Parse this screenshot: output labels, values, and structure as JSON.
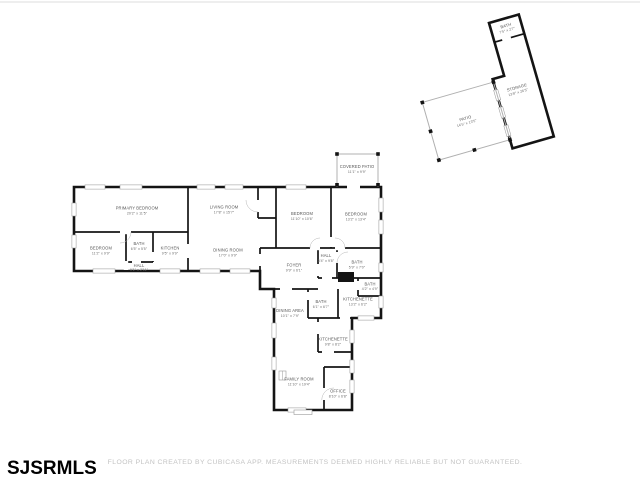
{
  "branding": {
    "logo": "SJSRMLS"
  },
  "footer": {
    "disclaimer": "FLOOR PLAN CREATED BY CUBICASA APP. MEASUREMENTS DEEMED HIGHLY RELIABLE BUT NOT GUARANTEED."
  },
  "colors": {
    "wall": "#141414",
    "label": "#555555",
    "window": "#9a9a9a",
    "patio_wall": "#b0b0b0",
    "disclaimer": "#c3c3c3",
    "background": "#ffffff"
  },
  "rooms": [
    {
      "name": "PRIMARY BEDROOM",
      "dims": "20'2\" x 11'5\""
    },
    {
      "name": "LIVING ROOM",
      "dims": "17'8\" x 15'7\""
    },
    {
      "name": "DINING ROOM",
      "dims": "17'0\" x 9'9\""
    },
    {
      "name": "BEDROOM",
      "dims": "11'2\" x 9'9\""
    },
    {
      "name": "BATH",
      "dims": "6'5\" x 5'5\""
    },
    {
      "name": "KITCHEN",
      "dims": "9'5\" x 9'9\""
    },
    {
      "name": "HALL",
      "dims": "9'1\" x 2'11\""
    },
    {
      "name": "BEDROOM",
      "dims": "11'10\" x 10'6\""
    },
    {
      "name": "BEDROOM",
      "dims": "13'2\" x 13'4\""
    },
    {
      "name": "HALL",
      "dims": "3'4\" x 9'8\""
    },
    {
      "name": "BATH",
      "dims": "5'9\" x 7'0\""
    },
    {
      "name": "FOYER",
      "dims": "9'9\" x 6'1\""
    },
    {
      "name": "BATH",
      "dims": "4'2\" x 4'9\""
    },
    {
      "name": "KITCHENETTE",
      "dims": "13'2\" x 6'2\""
    },
    {
      "name": "COVERED PATIO",
      "dims": "11'1\" x 9'9\""
    },
    {
      "name": "DINING AREA",
      "dims": "10'1\" x 7'9\""
    },
    {
      "name": "BATH",
      "dims": "6'1\" x 6'7\""
    },
    {
      "name": "KITCHENETTE",
      "dims": "9'8\" x 8'2\""
    },
    {
      "name": "FAMILY ROOM",
      "dims": "11'10\" x 19'4\""
    },
    {
      "name": "OFFICE",
      "dims": "8'10\" x 6'8\""
    },
    {
      "name": "BATH",
      "dims": "7'5\" x 2'7\""
    },
    {
      "name": "STORAGE",
      "dims": "13'8\" x 26'5\""
    },
    {
      "name": "PATIO",
      "dims": "14'5\" x 13'5\""
    }
  ]
}
